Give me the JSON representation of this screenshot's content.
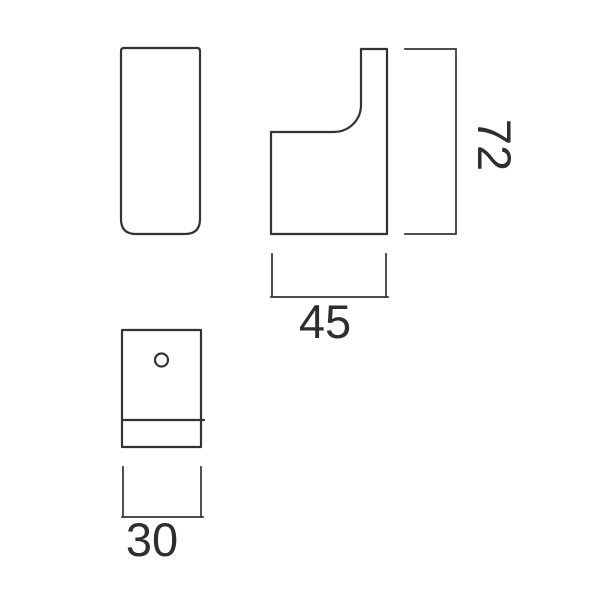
{
  "drawing": {
    "dimensions": {
      "height": "72",
      "depth": "45",
      "width": "30"
    },
    "colors": {
      "line": "#333333",
      "text": "#2e2e2e",
      "background": "#ffffff"
    }
  }
}
